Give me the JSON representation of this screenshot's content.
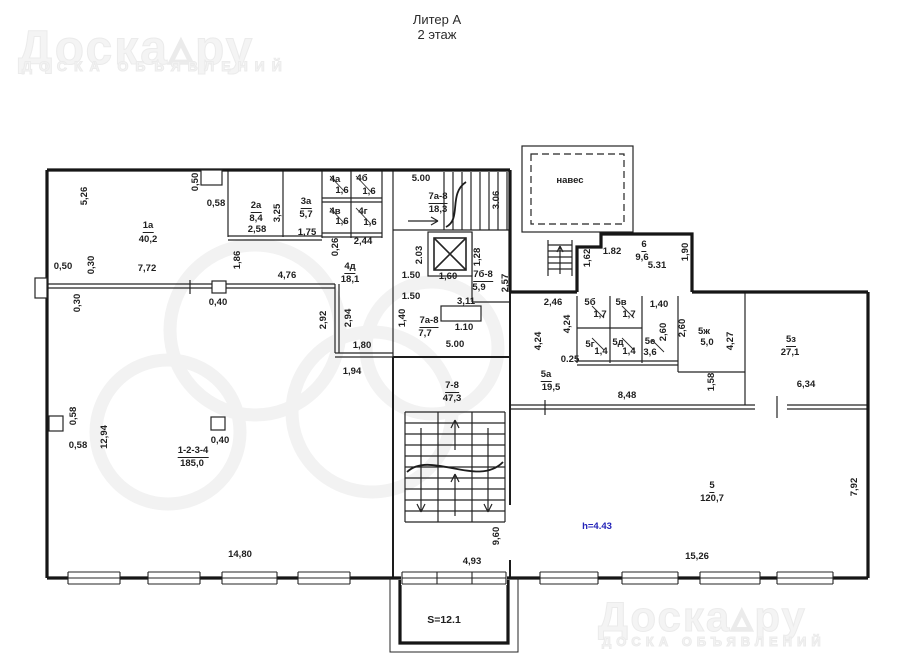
{
  "title": {
    "line1": "Литер А",
    "line2": "2 этаж"
  },
  "watermark": {
    "logo": "Доска▵ру",
    "tagline": "ДОСКА ОБЪЯВЛЕНИЙ"
  },
  "plan": {
    "labels": [
      {
        "n": "room-1a-name",
        "t": "1а",
        "x": 148,
        "y": 227,
        "c": "u"
      },
      {
        "n": "room-1a-area",
        "t": "40,2",
        "x": 148,
        "y": 240
      },
      {
        "n": "room-2a-name",
        "t": "2а",
        "x": 256,
        "y": 207,
        "c": "u"
      },
      {
        "n": "room-2a-area",
        "t": "8,4",
        "x": 256,
        "y": 219
      },
      {
        "n": "room-3a-name",
        "t": "3а",
        "x": 306,
        "y": 203,
        "c": "u"
      },
      {
        "n": "room-3a-area",
        "t": "5,7",
        "x": 306,
        "y": 215
      },
      {
        "n": "room-4a-name",
        "t": "4а",
        "x": 335,
        "y": 180
      },
      {
        "n": "room-4a-area",
        "t": "1,6",
        "x": 342,
        "y": 191
      },
      {
        "n": "room-4b-name",
        "t": "4б",
        "x": 362,
        "y": 179
      },
      {
        "n": "room-4b-area",
        "t": "1,6",
        "x": 369,
        "y": 192
      },
      {
        "n": "room-4v-name",
        "t": "4в",
        "x": 335,
        "y": 212
      },
      {
        "n": "room-4v-area",
        "t": "1,6",
        "x": 342,
        "y": 222
      },
      {
        "n": "room-4g-name",
        "t": "4г",
        "x": 363,
        "y": 212
      },
      {
        "n": "room-4g-area",
        "t": "1,6",
        "x": 370,
        "y": 223
      },
      {
        "n": "room-4d-name",
        "t": "4д",
        "x": 350,
        "y": 268,
        "c": "u"
      },
      {
        "n": "room-4d-area",
        "t": "18,1",
        "x": 350,
        "y": 280
      },
      {
        "n": "stair-7a8-name",
        "t": "7а-8",
        "x": 438,
        "y": 198,
        "c": "u"
      },
      {
        "n": "stair-7a8-area",
        "t": "18,3",
        "x": 438,
        "y": 210
      },
      {
        "n": "room-7b8-name",
        "t": "7б-8",
        "x": 483,
        "y": 276,
        "c": "u"
      },
      {
        "n": "room-7b8-area",
        "t": "5,9",
        "x": 479,
        "y": 288
      },
      {
        "n": "room-7a8s-name",
        "t": "7а-8",
        "x": 429,
        "y": 322,
        "c": "u"
      },
      {
        "n": "room-7a8s-area",
        "t": "7,7",
        "x": 425,
        "y": 334
      },
      {
        "n": "room-6-name",
        "t": "6",
        "x": 644,
        "y": 246,
        "c": "u"
      },
      {
        "n": "room-6-area",
        "t": "9,6",
        "x": 642,
        "y": 258
      },
      {
        "n": "room-5b-name",
        "t": "5б",
        "x": 590,
        "y": 303
      },
      {
        "n": "room-5b-area",
        "t": "1,7",
        "x": 600,
        "y": 315
      },
      {
        "n": "room-5v-name",
        "t": "5в",
        "x": 621,
        "y": 303
      },
      {
        "n": "room-5v-area",
        "t": "1,7",
        "x": 629,
        "y": 315
      },
      {
        "n": "room-5g-name",
        "t": "5г",
        "x": 590,
        "y": 345
      },
      {
        "n": "room-5g-area",
        "t": "1,4",
        "x": 601,
        "y": 352
      },
      {
        "n": "room-5d-name",
        "t": "5д",
        "x": 618,
        "y": 343
      },
      {
        "n": "room-5d-area",
        "t": "1,4",
        "x": 629,
        "y": 352
      },
      {
        "n": "room-5e-name",
        "t": "5е",
        "x": 650,
        "y": 342
      },
      {
        "n": "room-5e-area",
        "t": "3,6",
        "x": 650,
        "y": 353
      },
      {
        "n": "room-5zh-name",
        "t": "5ж",
        "x": 704,
        "y": 332
      },
      {
        "n": "room-5zh-area",
        "t": "5,0",
        "x": 707,
        "y": 343
      },
      {
        "n": "room-5z-name",
        "t": "5з",
        "x": 791,
        "y": 341,
        "c": "u"
      },
      {
        "n": "room-5z-area",
        "t": "27,1",
        "x": 790,
        "y": 353
      },
      {
        "n": "room-5a-name",
        "t": "5а",
        "x": 546,
        "y": 376,
        "c": "u"
      },
      {
        "n": "room-5a-area",
        "t": "19,5",
        "x": 551,
        "y": 388
      },
      {
        "n": "stair-78-name",
        "t": "7-8",
        "x": 452,
        "y": 387,
        "c": "u"
      },
      {
        "n": "stair-78-area",
        "t": "47,3",
        "x": 452,
        "y": 399
      },
      {
        "n": "room-1234-name",
        "t": "1-2-3-4",
        "x": 193,
        "y": 452,
        "c": "u"
      },
      {
        "n": "room-1234-area",
        "t": "185,0",
        "x": 192,
        "y": 464
      },
      {
        "n": "room-5-name",
        "t": "5",
        "x": 712,
        "y": 487,
        "c": "u"
      },
      {
        "n": "room-5-area",
        "t": "120,7",
        "x": 712,
        "y": 499
      },
      {
        "n": "naves-label",
        "t": "навес",
        "x": 570,
        "y": 181
      },
      {
        "n": "dim-5-26",
        "t": "5,26",
        "x": 85,
        "y": 196,
        "r": 1
      },
      {
        "n": "dim-0-50-top",
        "t": "0,50",
        "x": 196,
        "y": 182,
        "r": 1
      },
      {
        "n": "dim-0-58-top",
        "t": "0,58",
        "x": 216,
        "y": 204
      },
      {
        "n": "dim-3-25",
        "t": "3,25",
        "x": 278,
        "y": 213,
        "r": 1
      },
      {
        "n": "dim-2-58",
        "t": "2,58",
        "x": 257,
        "y": 230
      },
      {
        "n": "dim-1-75",
        "t": "1,75",
        "x": 307,
        "y": 233
      },
      {
        "n": "dim-1-86",
        "t": "1,86",
        "x": 238,
        "y": 260,
        "r": 1
      },
      {
        "n": "dim-4-76",
        "t": "4,76",
        "x": 287,
        "y": 276
      },
      {
        "n": "dim-0-50-left",
        "t": "0,50",
        "x": 63,
        "y": 267
      },
      {
        "n": "dim-0-30-a",
        "t": "0,30",
        "x": 92,
        "y": 265,
        "r": 1
      },
      {
        "n": "dim-0-30-b",
        "t": "0,30",
        "x": 78,
        "y": 303,
        "r": 1
      },
      {
        "n": "dim-7-72",
        "t": "7,72",
        "x": 147,
        "y": 269
      },
      {
        "n": "dim-0-40-a",
        "t": "0,40",
        "x": 218,
        "y": 303
      },
      {
        "n": "dim-0-26",
        "t": "0,26",
        "x": 336,
        "y": 247,
        "r": 1
      },
      {
        "n": "dim-2-44",
        "t": "2,44",
        "x": 363,
        "y": 242
      },
      {
        "n": "dim-2-92",
        "t": "2,92",
        "x": 324,
        "y": 320,
        "r": 1
      },
      {
        "n": "dim-2-94",
        "t": "2,94",
        "x": 349,
        "y": 318,
        "r": 1
      },
      {
        "n": "dim-1-80",
        "t": "1,80",
        "x": 362,
        "y": 346
      },
      {
        "n": "dim-1-94",
        "t": "1,94",
        "x": 352,
        "y": 372
      },
      {
        "n": "dim-5-00-top",
        "t": "5.00",
        "x": 421,
        "y": 179
      },
      {
        "n": "dim-3-06",
        "t": "3.06",
        "x": 497,
        "y": 200,
        "r": 1
      },
      {
        "n": "dim-2-03",
        "t": "2.03",
        "x": 420,
        "y": 255,
        "r": 1
      },
      {
        "n": "dim-1-28",
        "t": "1,28",
        "x": 478,
        "y": 257,
        "r": 1
      },
      {
        "n": "dim-1-50-a",
        "t": "1.50",
        "x": 411,
        "y": 276
      },
      {
        "n": "dim-1-50-b",
        "t": "1.50",
        "x": 411,
        "y": 297
      },
      {
        "n": "dim-1-60",
        "t": "1,60",
        "x": 448,
        "y": 277
      },
      {
        "n": "dim-2-57",
        "t": "2,57",
        "x": 506,
        "y": 283,
        "r": 1
      },
      {
        "n": "dim-1-40-mid",
        "t": "1,40",
        "x": 403,
        "y": 318,
        "r": 1
      },
      {
        "n": "dim-1-10",
        "t": "1.10",
        "x": 464,
        "y": 328
      },
      {
        "n": "dim-3-11",
        "t": "3,11",
        "x": 466,
        "y": 302
      },
      {
        "n": "dim-5-00-mid",
        "t": "5.00",
        "x": 455,
        "y": 345
      },
      {
        "n": "dim-2-46",
        "t": "2,46",
        "x": 553,
        "y": 303
      },
      {
        "n": "dim-1-62",
        "t": "1,62",
        "x": 588,
        "y": 258,
        "r": 1
      },
      {
        "n": "dim-1-82",
        "t": "1.82",
        "x": 612,
        "y": 252
      },
      {
        "n": "dim-5-31",
        "t": "5.31",
        "x": 657,
        "y": 266
      },
      {
        "n": "dim-1-90",
        "t": "1,90",
        "x": 686,
        "y": 252,
        "r": 1
      },
      {
        "n": "dim-4-24-a",
        "t": "4,24",
        "x": 539,
        "y": 341,
        "r": 1
      },
      {
        "n": "dim-4-24-b",
        "t": "4,24",
        "x": 568,
        "y": 324,
        "r": 1
      },
      {
        "n": "dim-0-25",
        "t": "0.25",
        "x": 570,
        "y": 360
      },
      {
        "n": "dim-1-40-r",
        "t": "1,40",
        "x": 659,
        "y": 305
      },
      {
        "n": "dim-2-60-a",
        "t": "2,60",
        "x": 664,
        "y": 332,
        "r": 1
      },
      {
        "n": "dim-2-60-b",
        "t": "2,60",
        "x": 683,
        "y": 328,
        "r": 1
      },
      {
        "n": "dim-4-27",
        "t": "4,27",
        "x": 731,
        "y": 341,
        "r": 1
      },
      {
        "n": "dim-1-58",
        "t": "1,58",
        "x": 712,
        "y": 382,
        "r": 1
      },
      {
        "n": "dim-8-48",
        "t": "8,48",
        "x": 627,
        "y": 396
      },
      {
        "n": "dim-6-34",
        "t": "6,34",
        "x": 806,
        "y": 385
      },
      {
        "n": "dim-0-58-v",
        "t": "0,58",
        "x": 74,
        "y": 416,
        "r": 1
      },
      {
        "n": "dim-0-58-h",
        "t": "0,58",
        "x": 78,
        "y": 446
      },
      {
        "n": "dim-12-94",
        "t": "12,94",
        "x": 105,
        "y": 437,
        "r": 1
      },
      {
        "n": "dim-0-40-b",
        "t": "0,40",
        "x": 220,
        "y": 441
      },
      {
        "n": "dim-14-80",
        "t": "14,80",
        "x": 240,
        "y": 555
      },
      {
        "n": "dim-9-60",
        "t": "9,60",
        "x": 497,
        "y": 536,
        "r": 1
      },
      {
        "n": "dim-4-93",
        "t": "4,93",
        "x": 472,
        "y": 562
      },
      {
        "n": "balcony-area",
        "t": "S=12.1",
        "x": 444,
        "y": 620,
        "c": "s"
      },
      {
        "n": "dim-15-26",
        "t": "15,26",
        "x": 697,
        "y": 557
      },
      {
        "n": "dim-7-92",
        "t": "7,92",
        "x": 855,
        "y": 487,
        "r": 1
      },
      {
        "n": "ceiling-height",
        "t": "h=4.43",
        "x": 597,
        "y": 527,
        "c": "blue"
      }
    ]
  }
}
